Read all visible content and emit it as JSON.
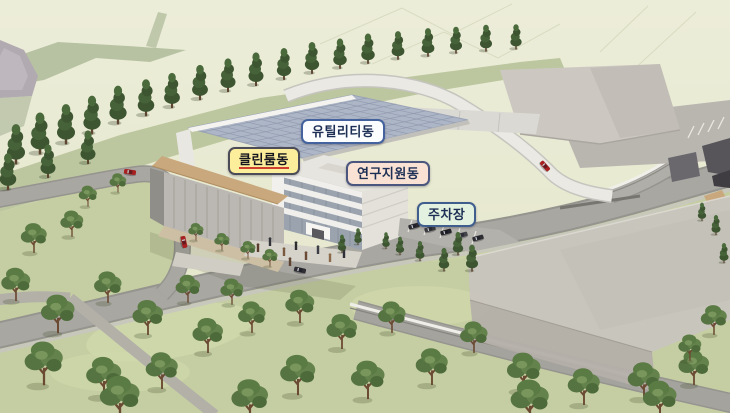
{
  "labels": {
    "utility": {
      "text": "유틸리티동",
      "bg": "#fbfdfe",
      "border": "#44639e"
    },
    "cleanroom": {
      "text": "클린룸동",
      "bg": "#fdee9b",
      "border": "#4c4c58",
      "underline": "#cf4030"
    },
    "research": {
      "text": "연구지원동",
      "bg": "#f9e2d3",
      "border": "#4a567e"
    },
    "parking": {
      "text": "주차장",
      "bg": "#e3f2e0",
      "border": "#3f5e8e"
    }
  },
  "palette": {
    "hillside": "#e8e9d1",
    "hill_shade": "#b7c2a2",
    "rock": "#b2aab1",
    "lawn": "#c5cea2",
    "conifer": "#3d5531",
    "deciduous": "#5b7b45",
    "road": "#a9a7a2",
    "back_road_white": "#ebe9e4",
    "cleanroom_roof_tan": "#c9a87d",
    "glazed_roof": "#adb6c6",
    "research_white": "#f0efeb",
    "warehouse": "#ccc8c1",
    "future_massing": "#c9c5be",
    "car_red": "#a8201f",
    "car_dark": "#2e2e34"
  }
}
